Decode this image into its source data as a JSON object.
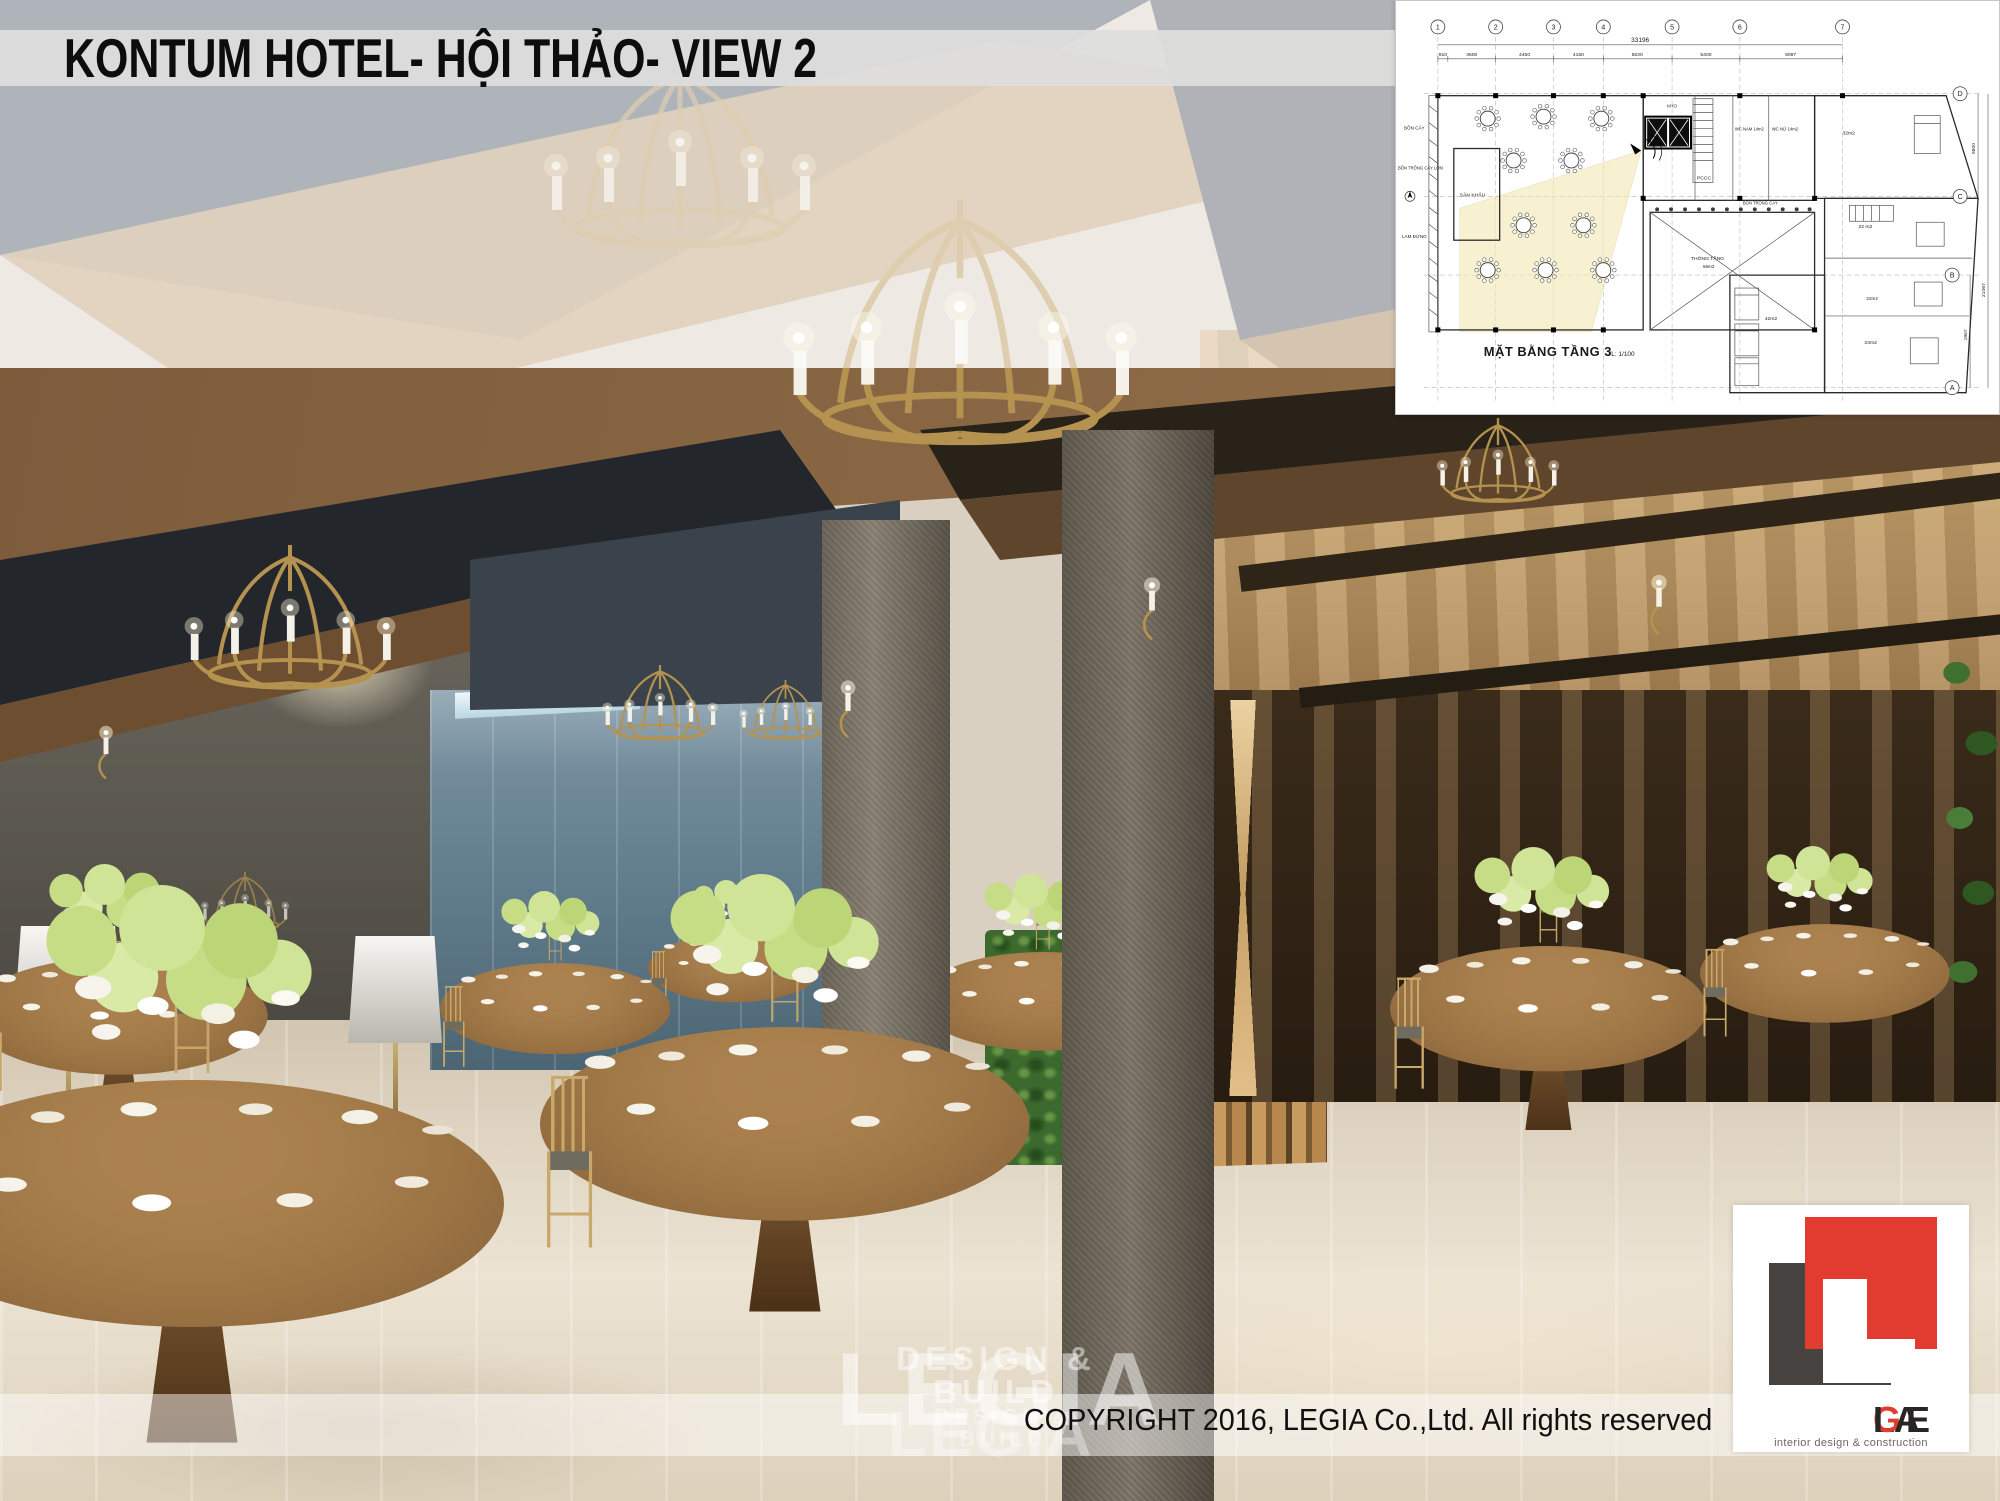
{
  "slide": {
    "title": "KONTUM HOTEL- HỘI THẢO- VIEW 2",
    "copyright": "COPYRIGHT 2016, LEGIA Co.,Ltd. All rights reserved"
  },
  "watermark": {
    "primary": {
      "name": "LEGIA",
      "tagline": "DESIGN & BUILD"
    },
    "secondary": {
      "name": "LEGIA",
      "tagline": "DESIGN & BUILD"
    }
  },
  "logo": {
    "letters_before": "LE",
    "letter_accent": "G",
    "letters_after": "IA",
    "tagline": "interior design & construction",
    "accent_red": "#e23b30",
    "dark_gray": "#474340"
  },
  "floor_plan": {
    "title": "MẶT BẰNG TẦNG 3",
    "scale_note": "TL: 1/100",
    "grid_cols": [
      "1",
      "2",
      "3",
      "4",
      "5",
      "6",
      "7"
    ],
    "grid_rows": [
      "D",
      "C",
      "B",
      "A"
    ],
    "dim_total": "33196",
    "dims_top": [
      "910",
      "3600",
      "4450",
      "4150",
      "5630",
      "5400",
      "8097"
    ],
    "dims_right": [
      "5800",
      "21067",
      "1967"
    ],
    "labels": {
      "bon_cay": "BỒN CÂY",
      "bon_trong_cay_lon": "BỒN TRỒNG CÂY LỚN",
      "lam_dung": "LAM ĐỨNG",
      "san_khau": "SÂN KHẤU",
      "kho": "KHO",
      "wc_nam": "WC NAM 14m2",
      "wc_nu": "WC NỮ 14m2",
      "room_32": "32m2",
      "room_22": "22 m2",
      "room_22b": "22m2",
      "room_42": "42m2",
      "room_23": "23m2",
      "thong_tang": "THÔNG TẦNG",
      "thong_tang_area": "56m2",
      "pccc": "PCCC",
      "bon_trong_cay": "BỒN TRỒNG CÂY"
    }
  },
  "scene_colors": {
    "gold_accent": "#c9a96b",
    "wood_ceiling": "#8a6847",
    "dark_coffer": "#24282d",
    "concrete_column": "#7b7567",
    "glass_wall": "#6d8495",
    "plant_green": "#3c6a2e",
    "floor": "#ddd2c0",
    "warm_wall": "#c8a070",
    "logo_red": "#e23b30"
  }
}
